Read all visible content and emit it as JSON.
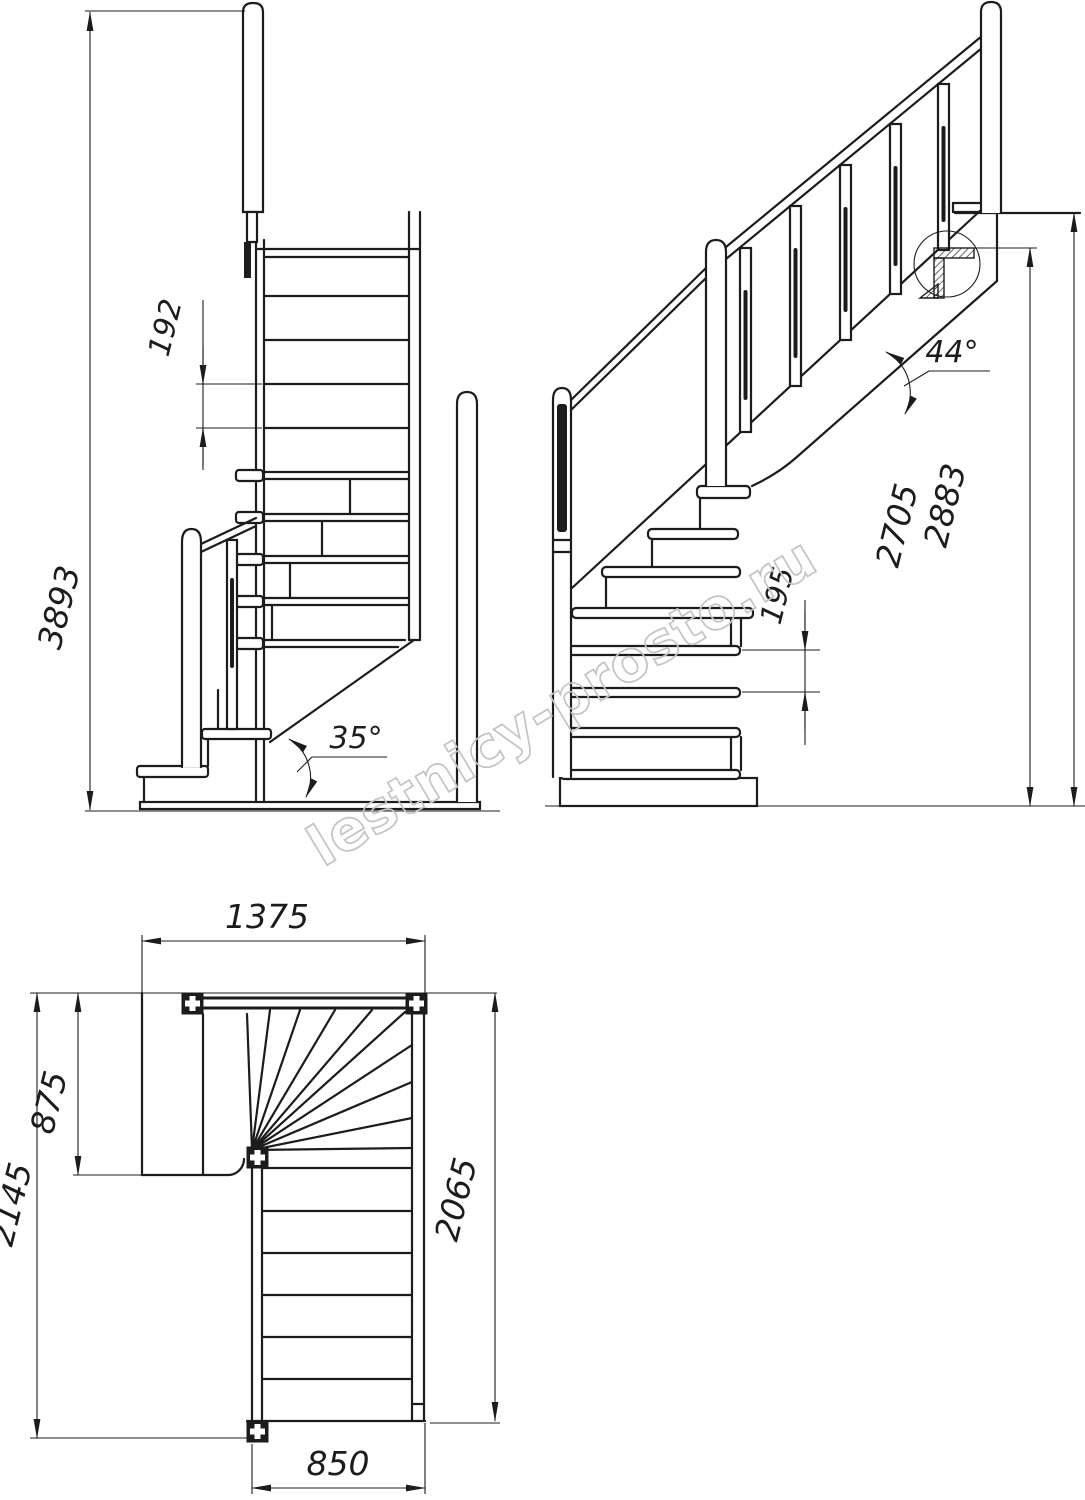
{
  "watermark": {
    "text": "lestnicy-prosto.ru",
    "color": "#c4c4c4"
  },
  "colors": {
    "line": "#1c1c1c",
    "background": "#ffffff"
  },
  "views": {
    "front_elevation": {
      "dimensions": {
        "total_height": "3893",
        "riser_height": "192",
        "stringer_angle": "35°"
      }
    },
    "side_elevation": {
      "dimensions": {
        "floor_to_landing_height": "2705",
        "total_height": "2883",
        "riser_height": "195",
        "flight_angle": "44°"
      }
    },
    "plan": {
      "dimensions": {
        "upper_flight_length": "1375",
        "landing_depth": "875",
        "total_depth": "2145",
        "lower_flight_length": "2065",
        "flight_width": "850"
      }
    }
  }
}
